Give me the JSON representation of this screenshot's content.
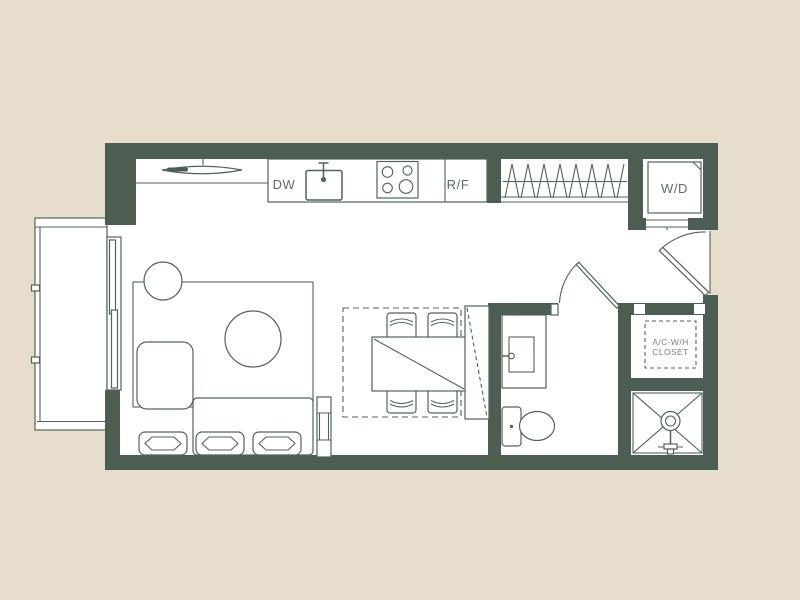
{
  "colors": {
    "background": "#e6ddcc",
    "wall": "#4c5e51",
    "line": "#51635a",
    "floor": "#ffffff",
    "label_text": "#5f6e64",
    "label_text_light": "#76847a"
  },
  "plan": {
    "labels": {
      "dishwasher": "DW",
      "fridge": "R/F",
      "washer_dryer": "W/D",
      "utility_line1": "A/C-W/H",
      "utility_line2": "CLOSET"
    }
  }
}
